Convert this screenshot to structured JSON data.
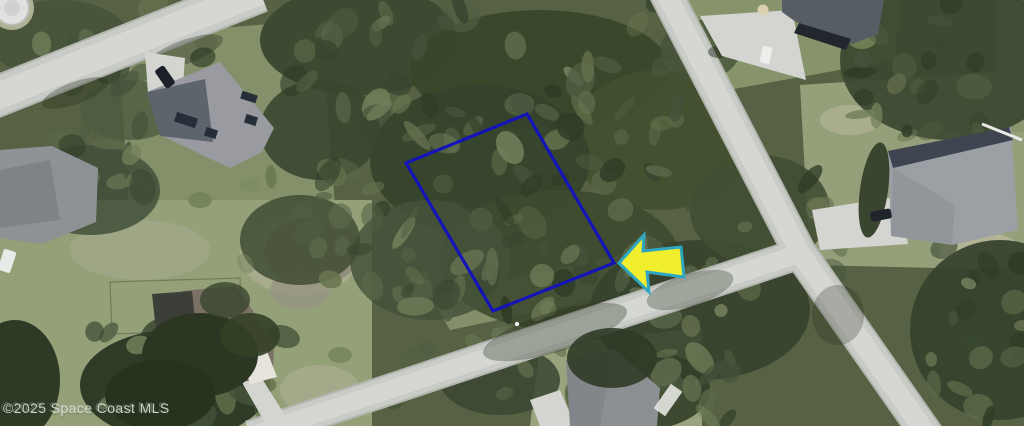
{
  "watermark": {
    "text": "©2025 Space Coast MLS"
  },
  "annotations": {
    "parcel_outline": {
      "points": "527,114 406,163 493,311 614,263",
      "color": "#1414b8",
      "stroke_width": "3.2"
    },
    "pointer_arrow": {
      "points": "619,263 644,235 643,251 681,247 684,277 647,272 649,292",
      "fill": "#f1ee2e",
      "stroke": "#2fa7c1",
      "stroke_width": "3"
    }
  },
  "colors": {
    "vegetation_base": "#566243",
    "road_gray": "#c9cbc6",
    "parcel_blue": "#1414b8",
    "arrow_yellow": "#f1ee2e",
    "arrow_teal": "#2fa7c1",
    "watermark_gray": "#e0e4df"
  }
}
